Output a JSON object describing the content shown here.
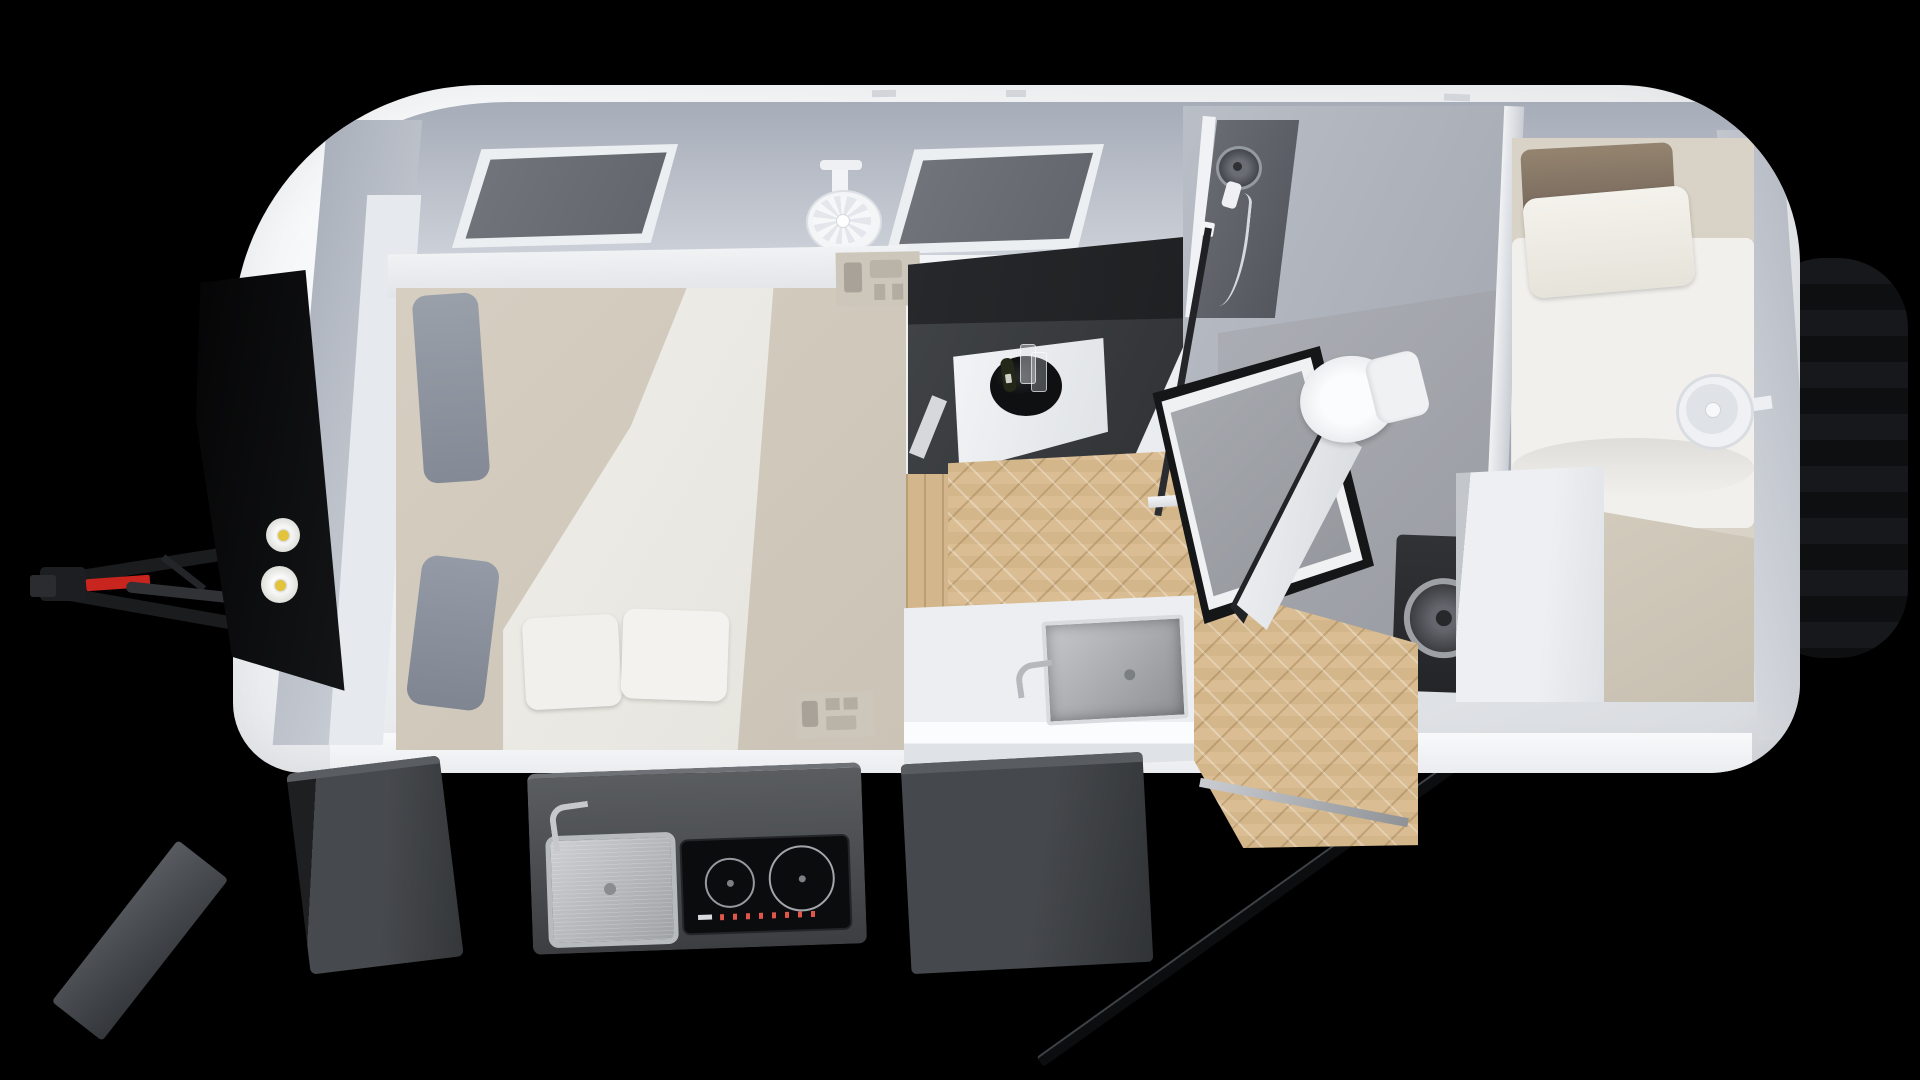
{
  "image": {
    "type": "3d-render-top-view-floorplan",
    "subject": "Compact caravan / travel trailer interior layout, roof removed, bird's-eye 3D render on black background",
    "width_px": 1920,
    "height_px": 1080,
    "visible_text": ""
  },
  "colors": {
    "bg": "#000000",
    "shell": "#f0f2f4",
    "wall": "#a6acb8",
    "wallLight": "#ccd0d8",
    "glass": "#60636a",
    "frame": "#eceff2",
    "mattress": "#d6cec1",
    "duvet": "#f1f0ec",
    "pillowGrey": "#9aa0aa",
    "pillowBrown": "#74655a",
    "bench": "#404346",
    "benchDark": "#26282b",
    "table": "#f2f4f6",
    "tray": "#0f1011",
    "wood": "#dabd93",
    "bathWall": "#b9bec7",
    "bathFloor": "#989ba1",
    "showerPanel": "#54575d",
    "glassFrame": "#1e1f22",
    "toilet": "#eff1f3",
    "steel": "#b5b8bc",
    "steelDark": "#8e9194",
    "hob": "#0b0c0e",
    "burner": "#96999e",
    "led": "#e2564a",
    "hatch": "#3c3e41",
    "hatchDark": "#303336",
    "tire": "#131416",
    "hitch": "#1b1c1e",
    "red": "#c8251f",
    "gasYellow": "#e4c33c"
  },
  "labels": {
    "body": "Caravan body shell",
    "window": "Side window",
    "ceiling_fan": "Ceiling fan",
    "double_bed": "Double bed with pillows and duvet",
    "switch_panel": "Power outlets and switches",
    "dinette": "Dinette bench seat",
    "table": "Dinette table",
    "wine_set": "Wine bottle and glasses on tray",
    "kitchen_counter": "Indoor kitchen counter",
    "kitchen_sink": "Indoor kitchen sink with faucet",
    "hall_floor": "Herringbone wood floor",
    "bathroom": "Bathroom compartment",
    "shower": "Shower with handheld shower head",
    "shower_tray": "Shower tray",
    "bathroom_door": "Bathroom door (open)",
    "toilet": "Toilet",
    "single_bed": "Single bed with pillows",
    "wall_fan": "Wall-mounted fan",
    "wardrobe": "Wardrobe cabinet",
    "washing_machine": "Washing machine",
    "entry_door": "Entry door (open)",
    "door_sill": "Entry door sill",
    "wheel": "Road wheel",
    "tow_hitch": "Tow hitch drawbar with red jockey handle",
    "front_locker": "Front storage locker (open)",
    "gas_bottles": "Gas bottles",
    "storage_hatch": "Open exterior storage hatch",
    "outdoor_kitchen": "Slide-out outdoor kitchen",
    "outdoor_sink": "Outdoor stainless sink",
    "induction_hob": "Two-burner induction hob",
    "front_lid": "Front hatch lid"
  }
}
